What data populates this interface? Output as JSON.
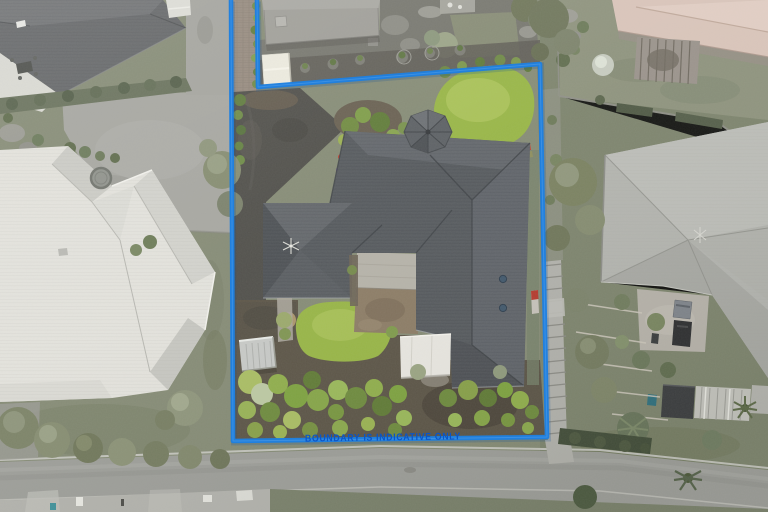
{
  "meta": {
    "view": "aerial-drone-photo",
    "subject": "residential property with blue boundary overlay"
  },
  "overlay": {
    "boundary_label": "BOUNDARY IS INDICATIVE ONLY"
  },
  "colors": {
    "boundary": "#1f80e0",
    "boundary_label": "#0a55c8",
    "ground": "#848a74",
    "road": "#9c9d98",
    "footpath": "#b2b2ac",
    "lawn": "#97b544",
    "driveway_dark": "#4e4d48",
    "shared_driveway": "#a5a59f",
    "main_roof": "#54585c",
    "west_roof": "#e3e2dc",
    "northwest_roof": "#636567",
    "north_roof": "#9e9d97",
    "northeast_roof": "#d9c4b9",
    "east_roof": "#b3b4af",
    "awning": "#e9e7e1",
    "shed": "#c7c9c6",
    "soil": "#5a5345"
  },
  "scene": {
    "subject_lot": {
      "features": [
        "main-house-roof",
        "turret-roof",
        "north-lawn",
        "west-lawn",
        "courtyard-pad",
        "white-awning",
        "garden-shed",
        "dark-driveway",
        "garden-beds",
        "skylights",
        "tv-antenna"
      ]
    },
    "neighbors": {
      "west": "white-tile-roof-house",
      "northwest": "dark-gray-roof-house",
      "north": "gray-hip-roof-house",
      "northeast": "tan-roof-house-with-pergola",
      "east": "gray-roof-house-with-carport-and-sheds"
    },
    "street": [
      "road",
      "kerb-lines",
      "footpath",
      "letterboxes",
      "street-trees",
      "stairway"
    ]
  }
}
